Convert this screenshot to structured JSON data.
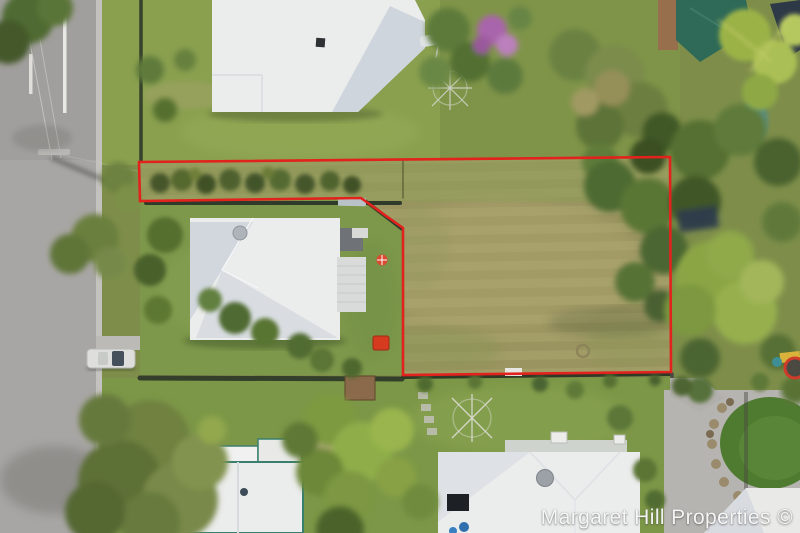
{
  "scene": {
    "kind": "aerial-drone-photograph",
    "subject": "Residential block with vacant grass land outlined by red property boundary"
  },
  "watermark": {
    "text": "Margaret Hill Properties ©"
  },
  "boundary": {
    "points": "139,162 670,157 671,372 403,375 403,228 361,198 140,201",
    "color": "#e2221c",
    "stroke_width": "2.6"
  },
  "palette": {
    "road": "#a8a6a4",
    "road_line": "#f0efec",
    "paddock_grass": "#a09a66",
    "lawn_green": "#7d984b",
    "top_yard": "#8aa04f",
    "roof_white": "#ebecec",
    "roof_shade": "#ccd3da",
    "teal_trim": "#3a7f6e",
    "teal_roof": "#2f6a58",
    "tree_green": "#5d7a3a",
    "tree_dark": "#44582b",
    "palm_bright": "#9bb247",
    "purple_bloom": "#a965ab",
    "driveway": "#b6b4b0",
    "dark_lawn": "#4f7b31",
    "boundary_red": "#e2221c",
    "red_toy": "#d63b20"
  }
}
